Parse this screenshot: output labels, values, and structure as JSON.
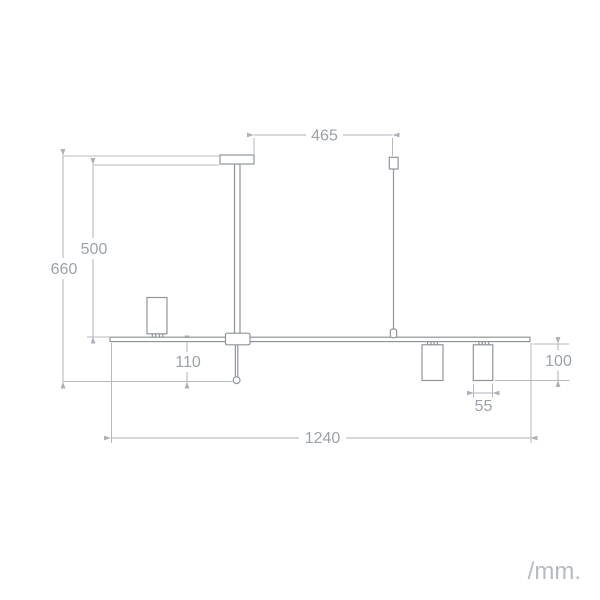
{
  "unit_label": "/mm.",
  "dimensions": {
    "canopy_to_cable": {
      "value": "465"
    },
    "canopy_to_bar_drop": {
      "value": "500"
    },
    "overall_drop": {
      "value": "660"
    },
    "stem_below_bar": {
      "value": "110"
    },
    "bar_length": {
      "value": "1240"
    },
    "spotlight_diameter": {
      "value": "55"
    },
    "spotlight_height": {
      "value": "100"
    }
  }
}
